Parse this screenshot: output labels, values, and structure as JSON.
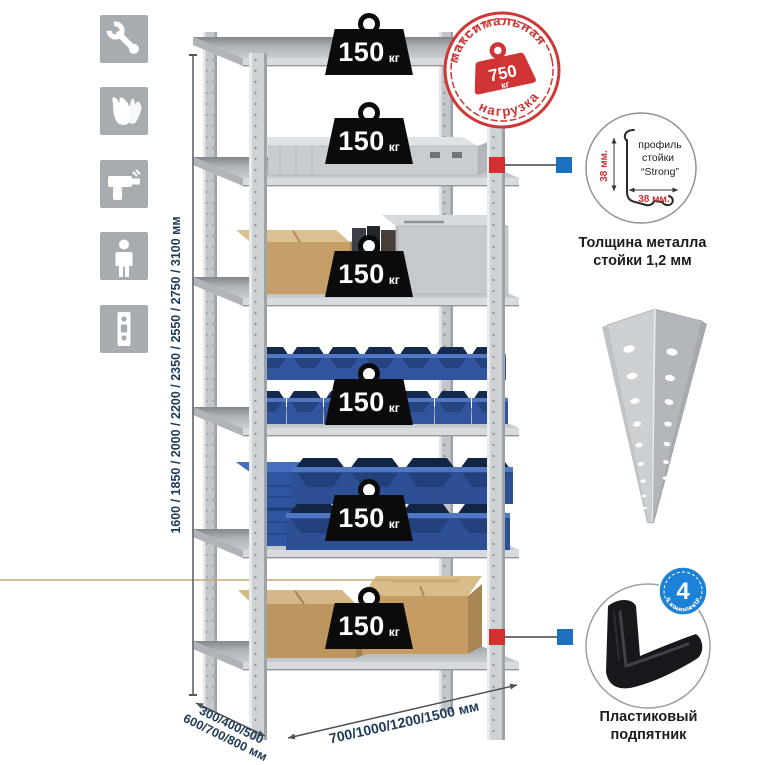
{
  "left_icons": [
    {
      "name": "wrench-icon"
    },
    {
      "name": "gloves-icon"
    },
    {
      "name": "drill-icon"
    },
    {
      "name": "person-icon"
    },
    {
      "name": "rack-post-icon"
    }
  ],
  "labels": {
    "height": "1600 / 1850 / 2000 / 2200 / 2350 / 2550 / 2750 / 3100 мм",
    "depth_line1": "300/400/500",
    "depth_line2": "600/700/800 мм",
    "width": "700/1000/1200/1500 мм"
  },
  "shelves": [
    {
      "load_value": "150",
      "load_unit": "кг"
    },
    {
      "load_value": "150",
      "load_unit": "кг"
    },
    {
      "load_value": "150",
      "load_unit": "кг"
    },
    {
      "load_value": "150",
      "load_unit": "кг"
    },
    {
      "load_value": "150",
      "load_unit": "кг"
    },
    {
      "load_value": "150",
      "load_unit": "кг"
    }
  ],
  "stamp": {
    "arc_top": "максимальная",
    "arc_bottom": "нагрузка",
    "value": "750",
    "unit": "кг"
  },
  "profile_callout": {
    "line1": "профиль",
    "line2": "стойки",
    "line3": "“Strong”",
    "dim_vertical": "38 мм.",
    "dim_horizontal": "38 мм.",
    "caption_line1": "Толщина металла",
    "caption_line2": "стойки 1,2 мм"
  },
  "foot_callout": {
    "badge_value": "4",
    "badge_text": "в комплекте",
    "caption_line1": "Пластиковый",
    "caption_line2": "подпятник"
  },
  "colors": {
    "stamp_red": "#cf3636",
    "marker_red": "#d32f2f",
    "marker_blue": "#1d6fc0",
    "bin_blue": "#30549e",
    "metal": "#c9cdd1",
    "dim_text": "#1e3a57"
  }
}
